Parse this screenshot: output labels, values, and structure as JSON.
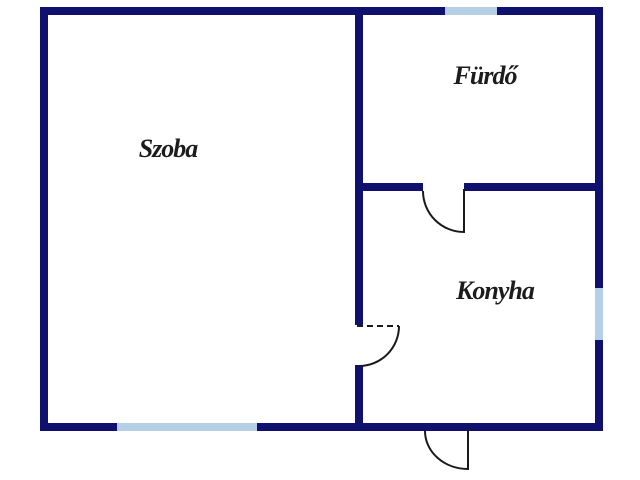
{
  "floorplan": {
    "rooms": [
      {
        "id": "szoba",
        "label": "Szoba"
      },
      {
        "id": "furdo",
        "label": "Fürdő"
      },
      {
        "id": "konyha",
        "label": "Konyha"
      }
    ],
    "colors": {
      "wall": "#10106e",
      "window": "#b5cfe7",
      "door": "#1a1a1a",
      "label_text": "#1c1c1c",
      "background": "#ffffff"
    }
  }
}
